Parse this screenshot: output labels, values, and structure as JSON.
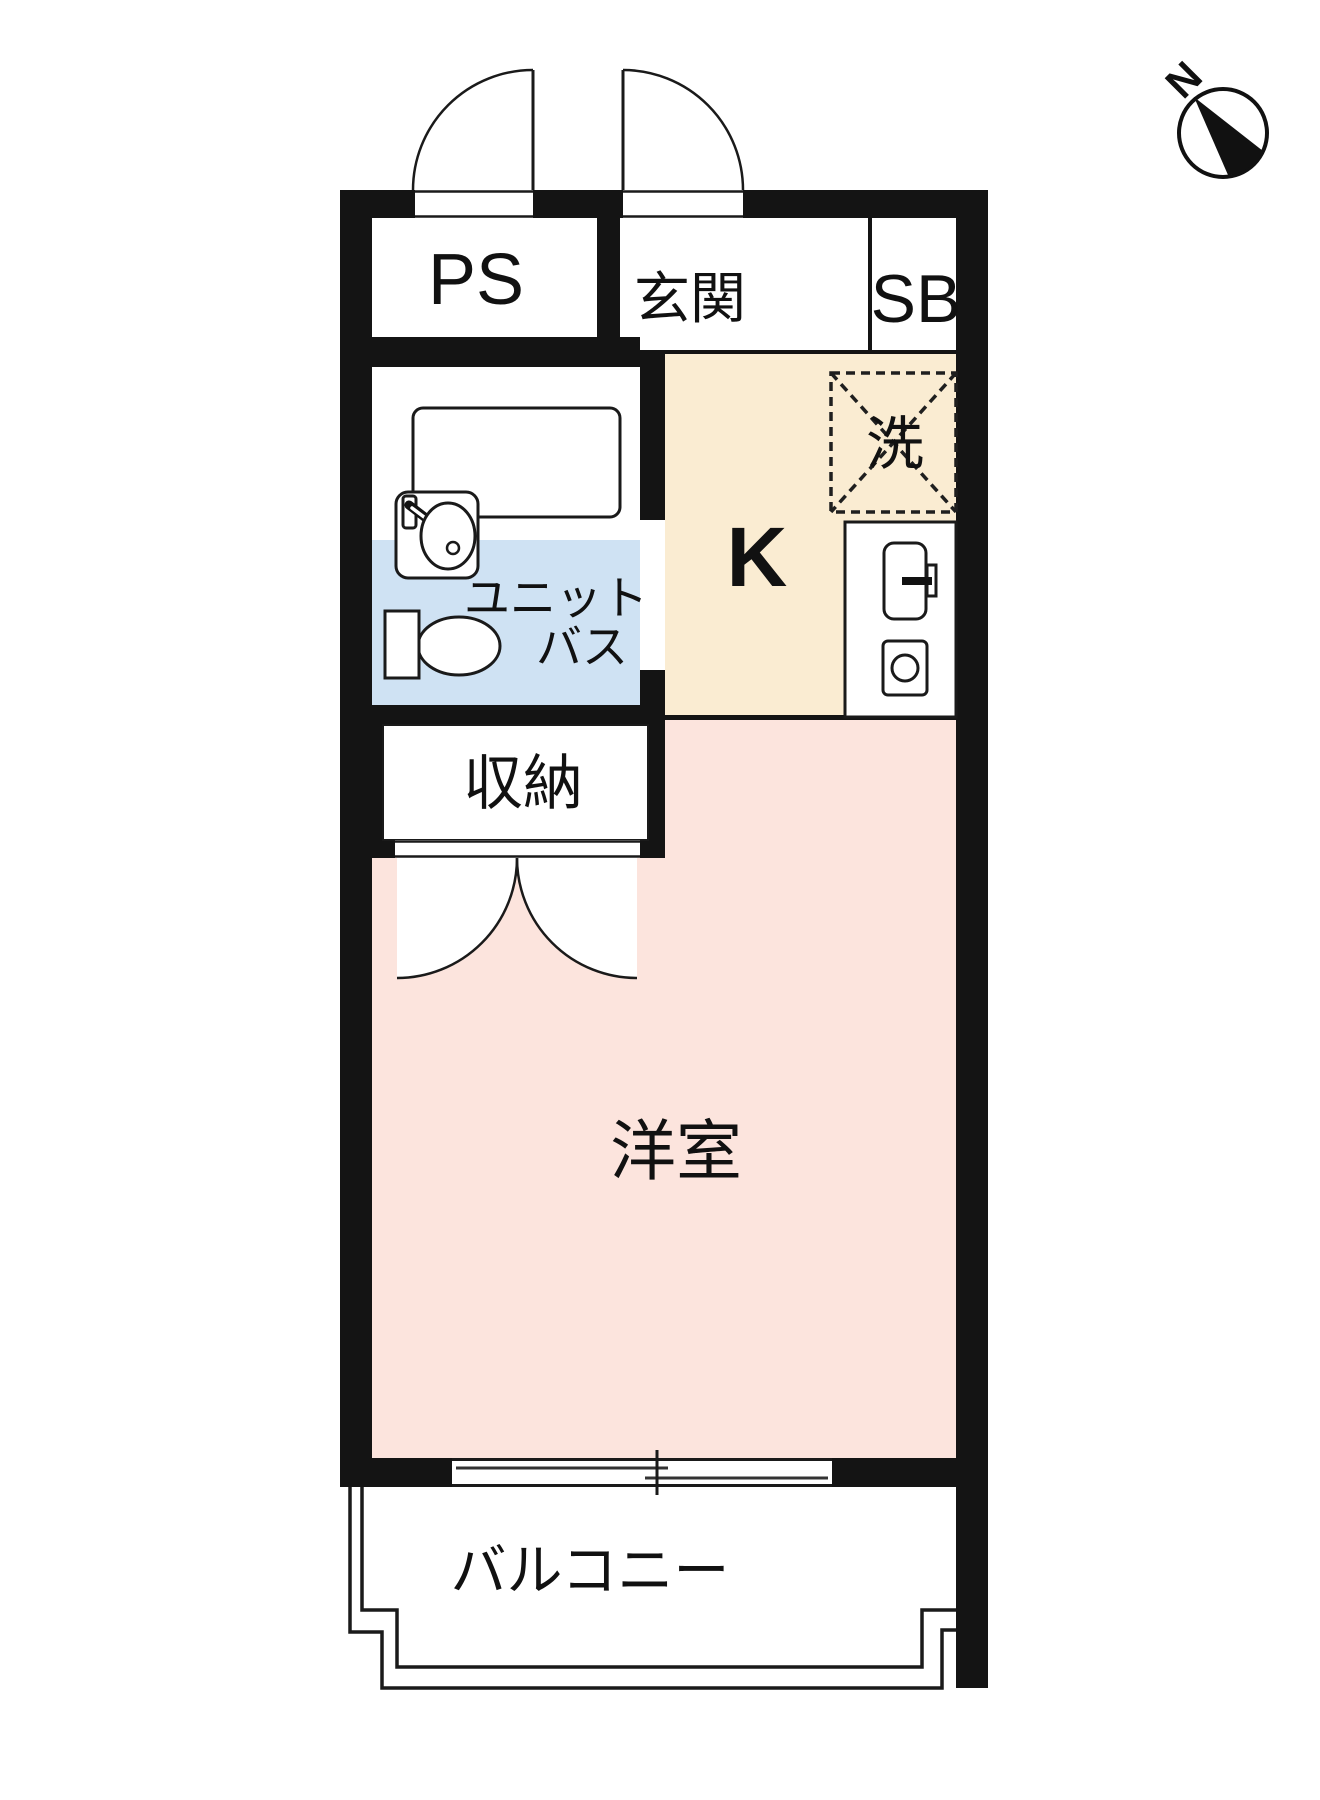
{
  "title": "apartment-floor-plan",
  "compass": {
    "north_label": "N"
  },
  "rooms": {
    "pipe_space": {
      "label": "PS"
    },
    "entrance": {
      "label": "玄関"
    },
    "shoe_box": {
      "label": "SB"
    },
    "washing_machine": {
      "label": "洗"
    },
    "kitchen": {
      "label": "K"
    },
    "unit_bath": {
      "label_line1": "ユニット",
      "label_line2": "バス"
    },
    "storage": {
      "label": "収納"
    },
    "western_room": {
      "label": "洋室"
    },
    "balcony": {
      "label": "バルコニー"
    }
  },
  "fixtures": [
    "bathtub",
    "wash-basin",
    "toilet",
    "kitchen-sink",
    "gas-burner",
    "washing-machine-space",
    "sliding-window",
    "entry-doors",
    "storage-double-doors"
  ],
  "colors": {
    "wall": "#141414",
    "line": "#1a1a1a",
    "kitchen_floor": "#faecd2",
    "western_room_floor": "#fce4dd",
    "unit_bath_floor": "#cfe2f3",
    "background": "#ffffff",
    "text": "#111111"
  }
}
